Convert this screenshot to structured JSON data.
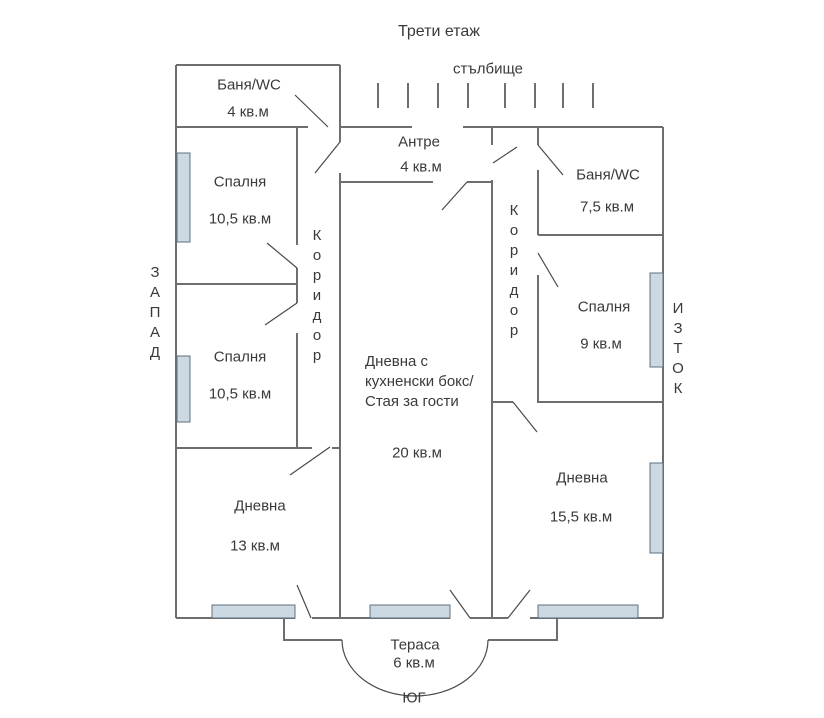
{
  "title": "Трети етаж",
  "stairwell": {
    "label": "стълбище"
  },
  "compass": {
    "west": "ЗАПАД",
    "east": "ИЗТОК",
    "south": "ЮГ"
  },
  "corridors": {
    "left": "Коридор",
    "right": "Коридор"
  },
  "rooms": {
    "bath_top_left": {
      "name": "Баня/WC",
      "area": "4 кв.м"
    },
    "entry": {
      "name": "Антре",
      "area": "4 кв.м"
    },
    "bath_right": {
      "name": "Баня/WC",
      "area": "7,5 кв.м"
    },
    "bedroom_left_1": {
      "name": "Спалня",
      "area": "10,5 кв.м"
    },
    "bedroom_left_2": {
      "name": "Спалня",
      "area": "10,5 кв.м"
    },
    "bedroom_right": {
      "name": "Спалня",
      "area": "9 кв.м"
    },
    "living_center": {
      "name": "Дневна с\nкухненски бокс/\nСтая за гости",
      "area": "20 кв.м"
    },
    "living_left": {
      "name": "Дневна",
      "area": "13 кв.м"
    },
    "living_right": {
      "name": "Дневна",
      "area": "15,5 кв.м"
    },
    "terrace": {
      "name": "Тераса",
      "area": "6 кв.м"
    }
  },
  "colors": {
    "wall": "#6e6e6e",
    "door": "#4a4a4a",
    "window_fill": "#ccd9e3",
    "window_border": "#5f707e",
    "text": "#3a3a3a"
  }
}
